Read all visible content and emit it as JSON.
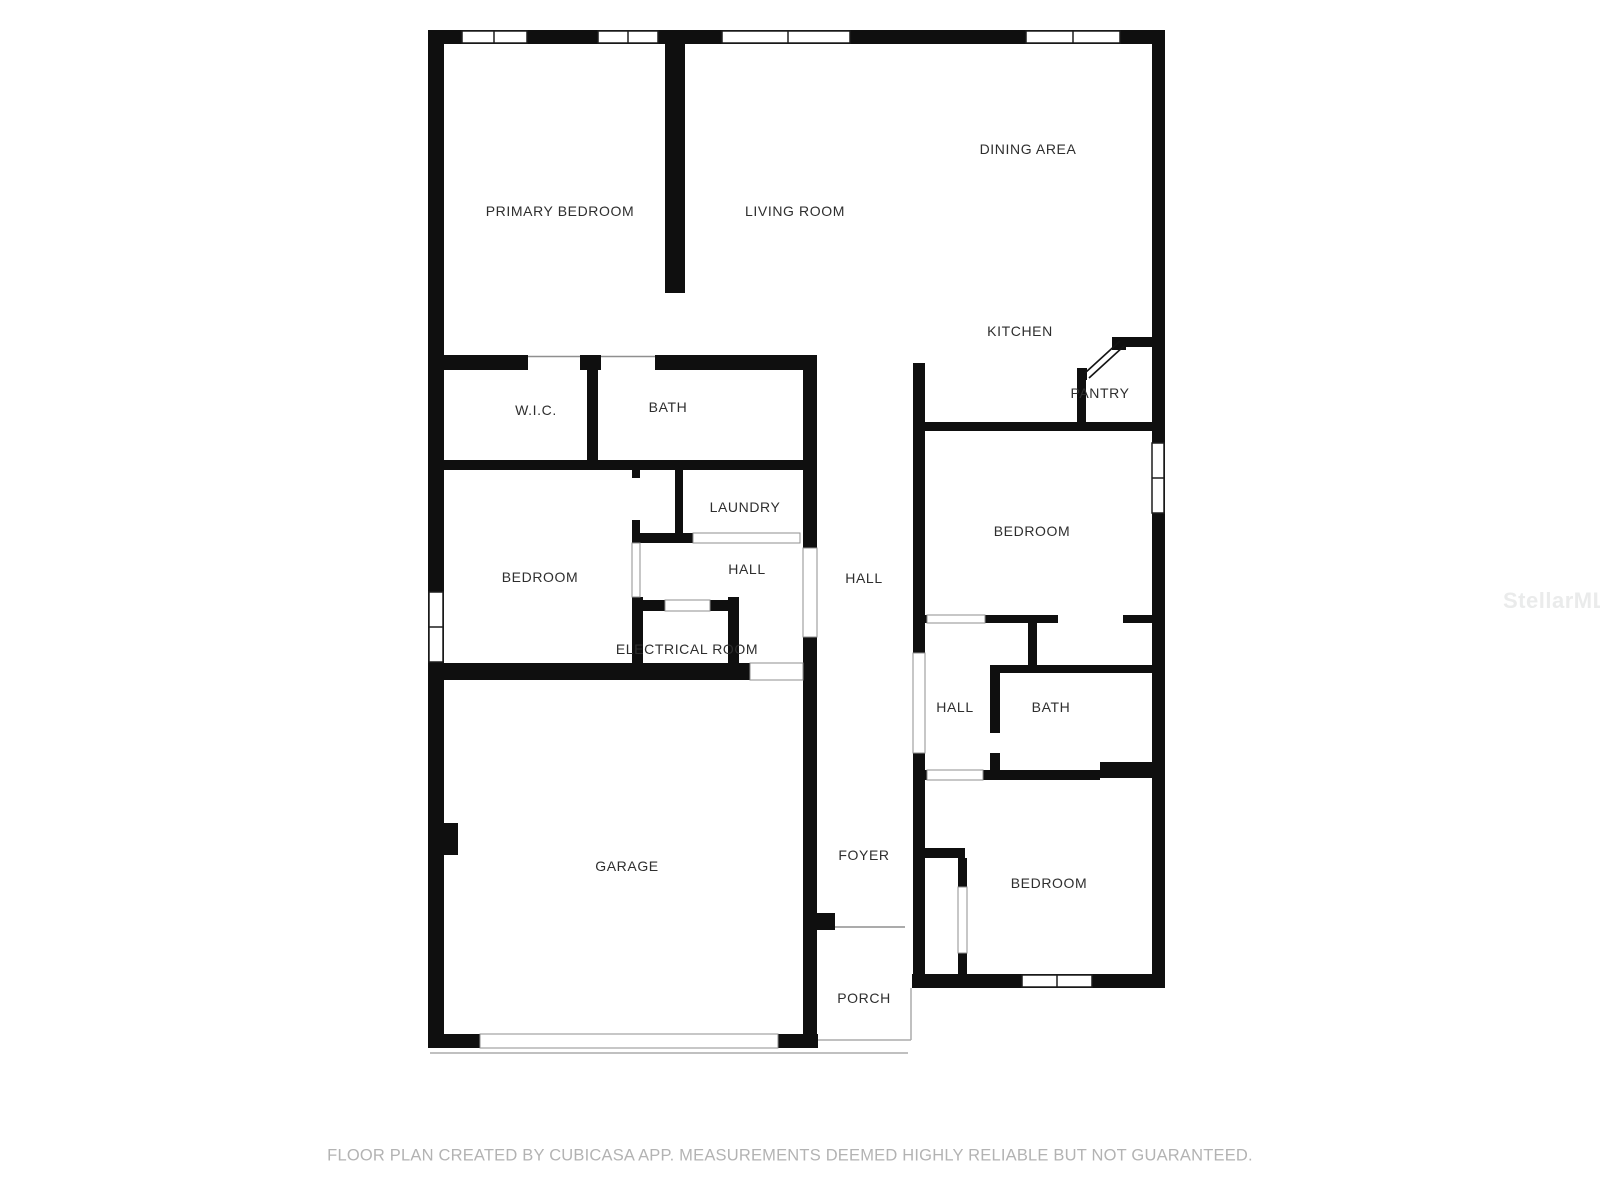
{
  "colors": {
    "background": "#ffffff",
    "wall": "#0f0f0f",
    "room_label": "#2e2e2e",
    "opening_frame": "#8f8f8f",
    "porch_outline": "#aaaaaa",
    "footer_text": "#b3b3b3",
    "watermark_text": "#eaebeb"
  },
  "rooms": {
    "primary_bedroom": {
      "label": "PRIMARY BEDROOM",
      "x": 560,
      "y": 211
    },
    "living_room": {
      "label": "LIVING ROOM",
      "x": 795,
      "y": 211
    },
    "dining_area": {
      "label": "DINING AREA",
      "x": 1028,
      "y": 149
    },
    "kitchen": {
      "label": "KITCHEN",
      "x": 1020,
      "y": 331
    },
    "pantry": {
      "label": "PANTRY",
      "x": 1100,
      "y": 393
    },
    "wic": {
      "label": "W.I.C.",
      "x": 536,
      "y": 410
    },
    "bath_primary": {
      "label": "BATH",
      "x": 668,
      "y": 407
    },
    "laundry": {
      "label": "LAUNDRY",
      "x": 745,
      "y": 507
    },
    "hall_left": {
      "label": "HALL",
      "x": 747,
      "y": 569
    },
    "bedroom_left": {
      "label": "BEDROOM",
      "x": 540,
      "y": 577
    },
    "electrical_room": {
      "label": "ELECTRICAL ROOM",
      "x": 687,
      "y": 649
    },
    "hall_center": {
      "label": "HALL",
      "x": 864,
      "y": 578
    },
    "bedroom_right": {
      "label": "BEDROOM",
      "x": 1032,
      "y": 531
    },
    "hall_right": {
      "label": "HALL",
      "x": 955,
      "y": 707
    },
    "bath_right": {
      "label": "BATH",
      "x": 1051,
      "y": 707
    },
    "foyer": {
      "label": "FOYER",
      "x": 864,
      "y": 855
    },
    "bedroom_bottom_right": {
      "label": "BEDROOM",
      "x": 1049,
      "y": 883
    },
    "garage": {
      "label": "GARAGE",
      "x": 627,
      "y": 866
    },
    "porch": {
      "label": "PORCH",
      "x": 864,
      "y": 998
    }
  },
  "footer": {
    "disclaimer": "FLOOR PLAN CREATED BY CUBICASA APP. MEASUREMENTS DEEMED HIGHLY RELIABLE BUT NOT GUARANTEED.",
    "x": 790,
    "y": 1156
  },
  "watermark": {
    "text": "StellarMLS",
    "x": 1503,
    "y": 588
  }
}
